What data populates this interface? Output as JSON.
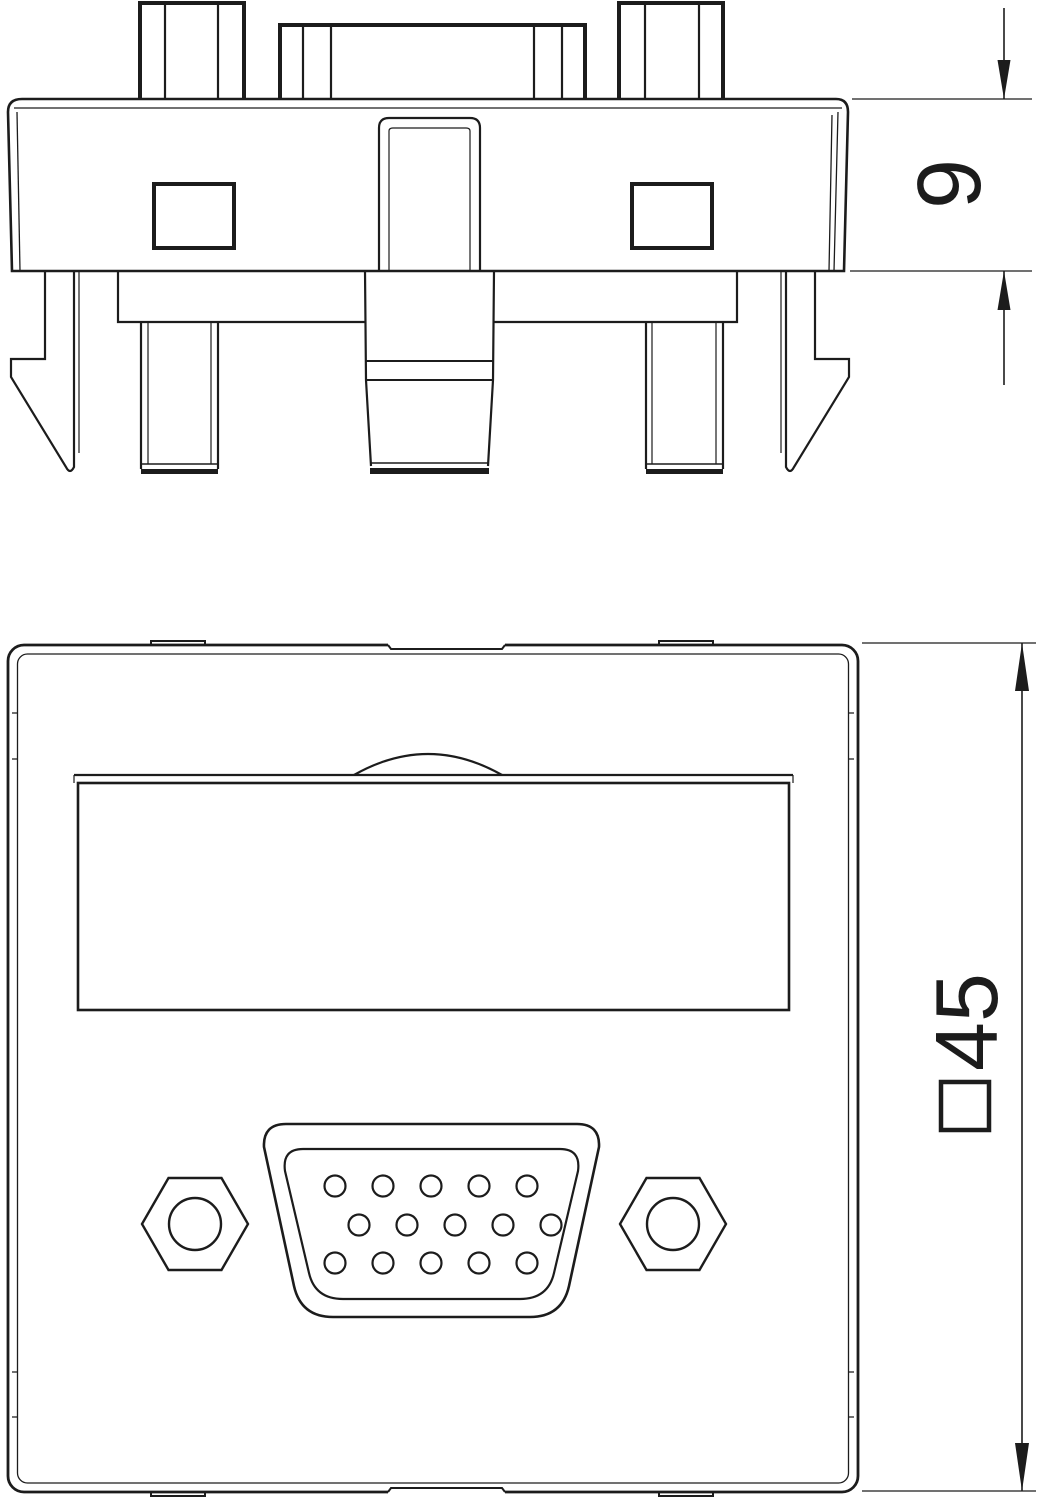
{
  "page": {
    "background": "#ffffff",
    "line_color": "#1c1c1c",
    "description_labels": []
  },
  "views": {
    "side": {
      "name": "side-profile-view"
    },
    "front": {
      "name": "front-face-view"
    }
  },
  "dimensions": {
    "depth": {
      "value": "9"
    },
    "face": {
      "value": "45",
      "symbol": "square-prefix"
    }
  },
  "connector": {
    "type": "vga-d-sub-15-socket",
    "pin_radius": 10.5,
    "pin_rows": [
      {
        "y": 1186,
        "xs": [
          335,
          383,
          431,
          479,
          527
        ]
      },
      {
        "y": 1225,
        "xs": [
          359,
          407,
          455,
          503,
          551
        ]
      },
      {
        "y": 1263,
        "xs": [
          335,
          383,
          431,
          479,
          527
        ]
      }
    ]
  }
}
